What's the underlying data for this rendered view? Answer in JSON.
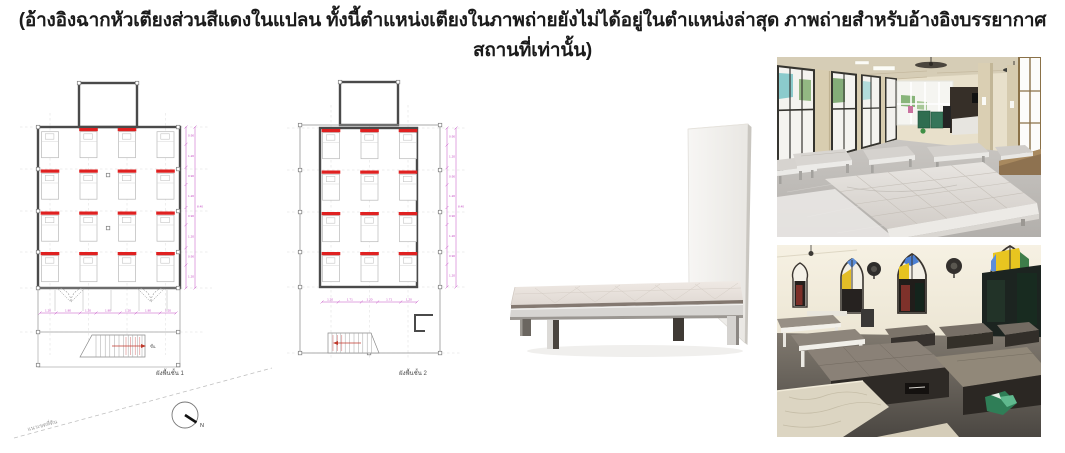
{
  "caption": {
    "text": "(อ้างอิงฉากหัวเตียงส่วนสีแดงในแปลน ทั้งนี้ตำแหน่งเตียงในภาพถ่ายยังไม่ได้อยู่ในตำแหน่งล่าสุด ภาพถ่ายสำหรับอ้างอิงบรรยากาศสถานที่เท่านั้น)"
  },
  "colors": {
    "headboard_red": "#e02020",
    "dimension_magenta": "#c44fc4",
    "wall_dark": "#4a4a4a"
  },
  "plans": {
    "floor1": {
      "label": "ผังพื้นชั้น 1",
      "bed_rows": 4,
      "bed_cols": 4,
      "bed_count": 16,
      "red_headboard_count": 14,
      "red_map": [
        "0110",
        "1111",
        "1111",
        "1111"
      ],
      "bottom_dims": [
        "1.20",
        "1.80",
        "1.20",
        "1.80",
        "1.20",
        "1.80",
        "1.20"
      ],
      "side_dims": [
        "0.90",
        "1.20",
        "0.90",
        "1.20",
        "0.90",
        "1.20",
        "0.90",
        "1.20"
      ],
      "stair_label": "ขึ้น"
    },
    "floor2": {
      "label": "ผังพื้นชั้น 2",
      "bed_rows": 4,
      "bed_cols": 3,
      "bed_count": 12,
      "red_headboard_count": 12,
      "red_map": [
        "111",
        "111",
        "111",
        "111"
      ],
      "bottom_dims": [
        "1.20",
        "1.71",
        "1.20",
        "1.71",
        "1.20"
      ],
      "side_dims": [
        "0.90",
        "1.20",
        "0.90",
        "1.20",
        "0.90",
        "1.20",
        "0.90",
        "1.20"
      ],
      "stair_label": "ขึ้น"
    }
  },
  "site": {
    "boundary_label": "แนวเขตที่ดิน",
    "north_label": "N"
  }
}
